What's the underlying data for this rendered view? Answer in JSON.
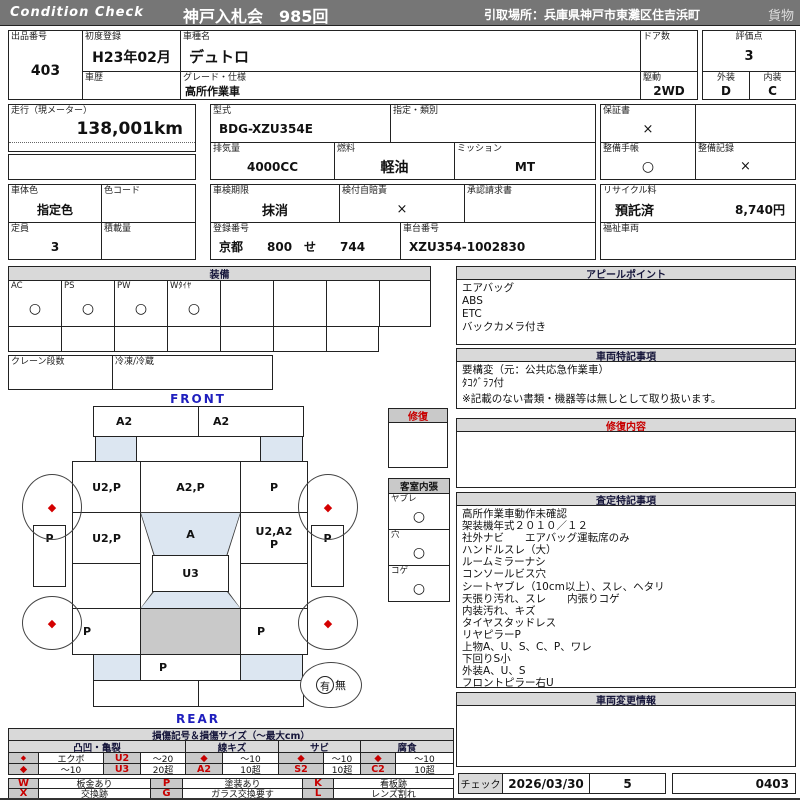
{
  "colors": {
    "topbar_gray": "#767676",
    "section_header_gray": "#d9d9d9",
    "symbol_cell_gray": "#c9c9c9",
    "accent_red": "#c80000",
    "diagram_blue": "#dce6f1",
    "cargo_bed_gray": "#c9c9c9",
    "front_rear_blue": "#1f1fbe"
  },
  "header": {
    "brand": "Condition  Check",
    "title": "神戸入札会　985回",
    "pickup": "引取場所：兵庫県神戸市東灘区住吉浜町",
    "category": "貨物"
  },
  "info": {
    "lot_label": "出品番号",
    "lot": "403",
    "first_reg_label": "初度登録",
    "first_reg": "H23年02月",
    "history_label": "車歴",
    "history": "",
    "model_label": "車種名",
    "model": "デュトロ",
    "spec_label": "グレード・仕様",
    "spec": "高所作業車",
    "doors_label": "ドア数",
    "doors": "",
    "drive_label": "駆動",
    "drive": "2WD",
    "score_label": "評価点",
    "score": "3",
    "exterior_label": "外装",
    "exterior": "D",
    "interior_label": "内装",
    "interior": "C",
    "mileage_label": "走行（現メーター）",
    "mileage": "138,001km",
    "model_code_label": "型式",
    "model_code": "BDG-XZU354E",
    "class_label": "指定・類別",
    "class_value": "",
    "warranty_label": "保証書",
    "warranty": "×",
    "displacement_label": "排気量",
    "displacement": "4000CC",
    "fuel_label": "燃料",
    "fuel": "軽油",
    "mission_label": "ミッション",
    "mission": "MT",
    "maint_book_label": "整備手帳",
    "maint_book": "○",
    "maint_record_label": "整備記録",
    "maint_record": "×",
    "body_color_label": "車体色",
    "body_color": "指定色",
    "color_code_label": "色コード",
    "color_code": "",
    "inspection_label": "車検期限",
    "inspection": "抹消",
    "insurance_label": "検付自賠責",
    "insurance": "×",
    "approval_label": "承認請求書",
    "approval": "",
    "recycle_label": "リサイクル料",
    "recycle_status": "預託済",
    "recycle_fee": "8,740円",
    "capacity_label": "定員",
    "capacity": "3",
    "payload_label": "積載量",
    "payload": "",
    "reg_no_label": "登録番号",
    "reg_no": "京都　　800　せ　　744",
    "chassis_label": "車台番号",
    "chassis": "XZU354-1002830",
    "welfare_label": "福祉車両",
    "welfare": ""
  },
  "equipment": {
    "title": "装備",
    "items": [
      {
        "label": "AC",
        "value": "○"
      },
      {
        "label": "PS",
        "value": "○"
      },
      {
        "label": "PW",
        "value": "○"
      },
      {
        "label": "Wﾀｲﾔ",
        "value": "○"
      },
      {
        "label": "",
        "value": ""
      },
      {
        "label": "",
        "value": ""
      },
      {
        "label": "",
        "value": ""
      },
      {
        "label": "",
        "value": ""
      }
    ],
    "crane_label": "クレーン段数",
    "crane": "",
    "reefer_label": "冷凍/冷蔵",
    "reefer": ""
  },
  "appeal": {
    "title": "アピールポイント",
    "lines": [
      "エアバッグ",
      "ABS",
      "ETC",
      "バックカメラ付き"
    ]
  },
  "notes": {
    "title": "車両特記事項",
    "lines": [
      "要構変（元：公共応急作業車）",
      "ﾀｺｸﾞﾗﾌ付"
    ],
    "disclaimer": "※記載のない書類・機器等は無しとして取り扱います。"
  },
  "repair": {
    "title": "修復内容",
    "content": ""
  },
  "assessment": {
    "title": "査定特記事項",
    "lines": [
      "高所作業車動作未確認",
      "架装機年式２０１０／１２",
      "社外ナビ　　エアバッグ運転席のみ",
      "ハンドルスレ（大）",
      "ルームミラーナシ",
      "コンソールビス穴",
      "シートヤブレ（10cm以上）、スレ、ヘタリ",
      "天張り汚れ、スレ　　内張りコゲ",
      "内装汚れ、キズ",
      "タイヤスタッドレス",
      "リヤピラーP",
      "上物A、U、S、C、P、ワレ",
      "下回りS小",
      "外装A、U、S",
      "フロントピラー右U"
    ]
  },
  "change_info": {
    "title": "車両変更情報",
    "content": ""
  },
  "check": {
    "label": "チェック",
    "date": "2026/03/30",
    "count": "5",
    "code": "0403"
  },
  "diagram": {
    "front": "FRONT",
    "rear": "REAR",
    "bumper_front_l": "A2",
    "bumper_front_r": "A2",
    "cab_l": "U2,P",
    "cab_c": "A2,P",
    "cab_r": "P",
    "mid_l": "U2,P",
    "mid_c": "A",
    "mid_r": "U2,A2\nP",
    "center": "U3",
    "side_l": "P",
    "side_r": "P",
    "rear_l": "P",
    "rear_r": "P",
    "rear_window": "P",
    "wheel_mark": "◆",
    "spare_yes": "有",
    "spare_no": "無",
    "repair_title": "修復",
    "cabin_title": "客室内張",
    "cabin_items": [
      {
        "label": "ヤブレ",
        "value": "○"
      },
      {
        "label": "穴",
        "value": "○"
      },
      {
        "label": "コゲ",
        "value": "○"
      }
    ]
  },
  "legend": {
    "title": "損傷記号＆損傷サイズ（～最大cm）",
    "groups": [
      "凸凹・亀裂",
      "線キズ",
      "サビ",
      "腐食"
    ],
    "row1": [
      "◆",
      "エクボ",
      "U2",
      "～20",
      "◆",
      "～10",
      "◆",
      "～10",
      "◆",
      "～10"
    ],
    "row2": [
      "◆",
      "～10",
      "U3",
      "20超",
      "A2",
      "10超",
      "S2",
      "10超",
      "C2",
      "10超"
    ],
    "codes": [
      [
        "W",
        "板金あり",
        "P",
        "塗装あり",
        "K",
        "看板跡"
      ],
      [
        "X",
        "交換跡",
        "G",
        "ガラス交換要す",
        "L",
        "レンズ割れ"
      ]
    ]
  }
}
